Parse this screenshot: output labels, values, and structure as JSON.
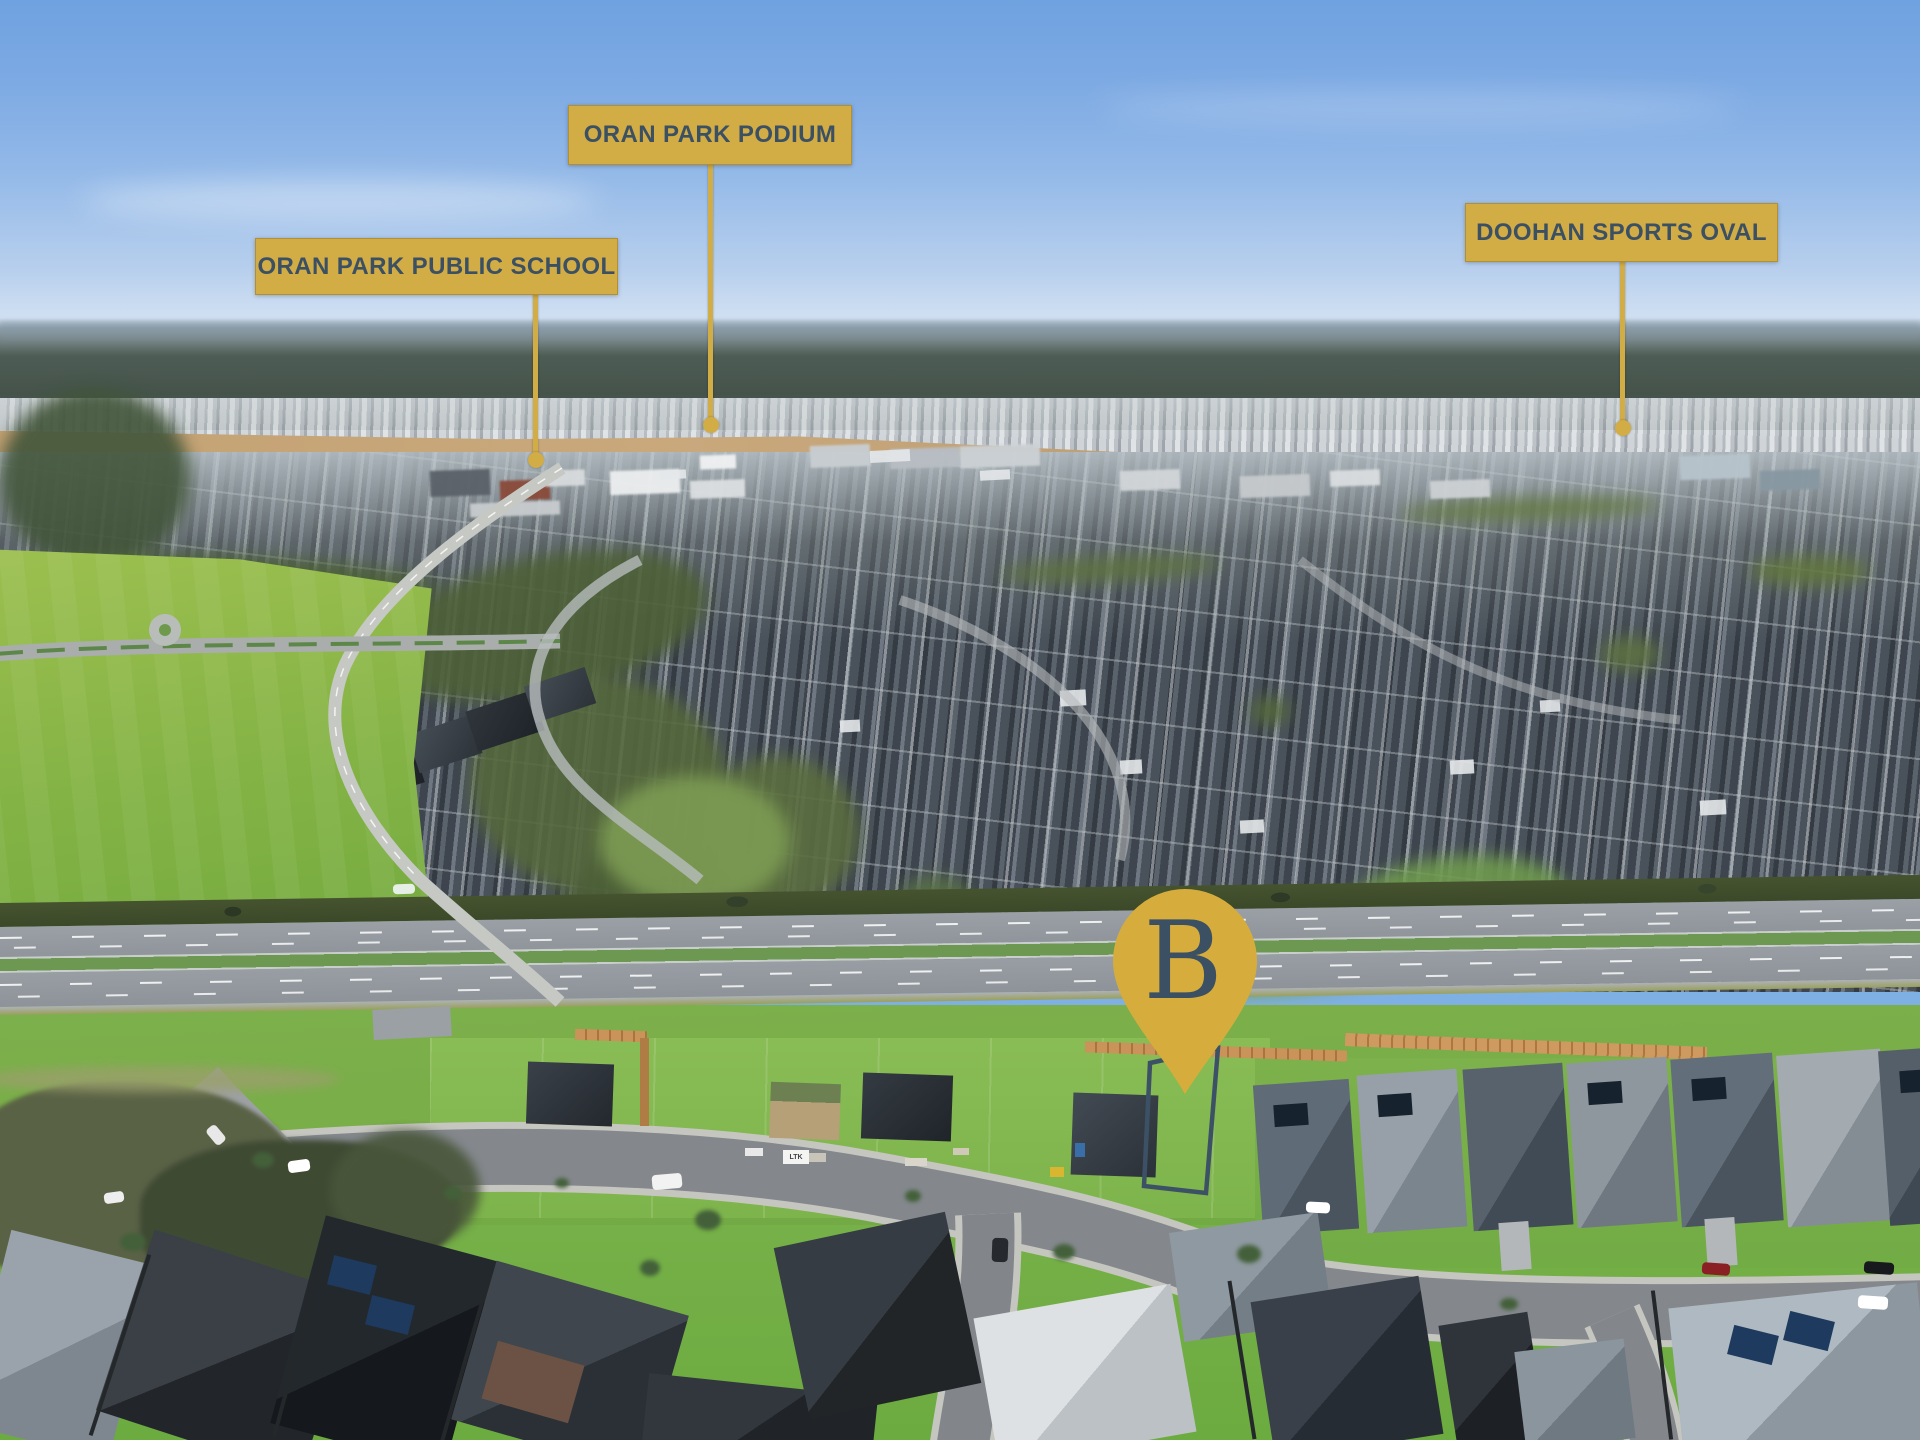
{
  "annotations": {
    "badges": [
      {
        "id": "oran-park-podium",
        "label": "ORAN PARK PODIUM"
      },
      {
        "id": "oran-park-public-school",
        "label": "ORAN PARK PUBLIC SCHOOL"
      },
      {
        "id": "doohan-sports-oval",
        "label": "DOOHAN SPORTS OVAL"
      }
    ],
    "pin": {
      "label": "B"
    },
    "micro_sign": {
      "label": "LTK"
    },
    "colors": {
      "gold": "#d2ac45",
      "navy": "#3c5063",
      "pin_gold": "#d6ad3c",
      "lot_outline": "#3d5166"
    }
  }
}
